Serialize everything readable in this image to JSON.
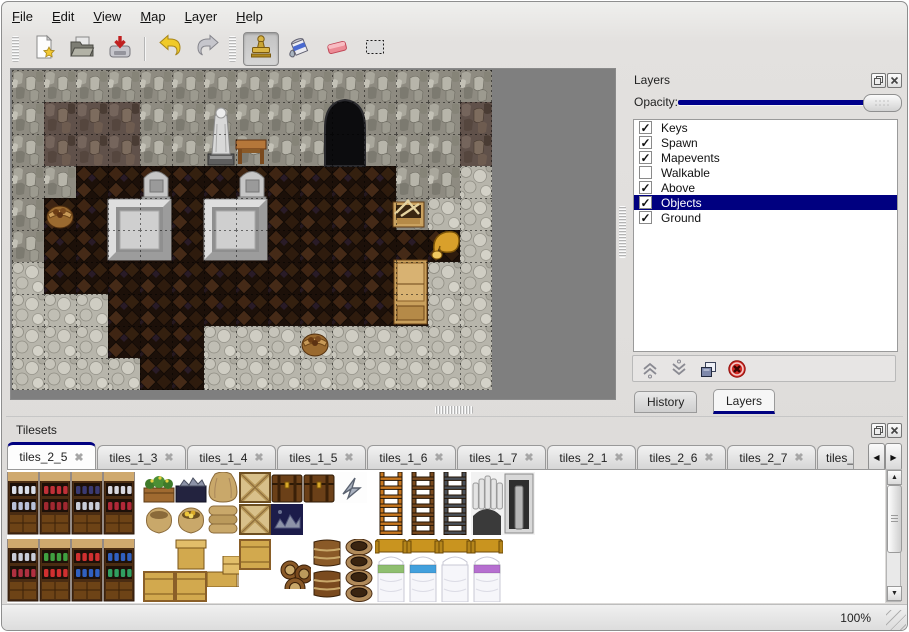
{
  "menu": {
    "items": [
      "File",
      "Edit",
      "View",
      "Map",
      "Layer",
      "Help"
    ]
  },
  "toolbar": {
    "buttons": [
      {
        "name": "new-file",
        "icon": "new"
      },
      {
        "name": "open-file",
        "icon": "open"
      },
      {
        "name": "save-file",
        "icon": "save"
      },
      {
        "name": "undo",
        "icon": "undo"
      },
      {
        "name": "redo",
        "icon": "redo"
      },
      {
        "name": "stamp-tool",
        "icon": "stamp",
        "active": true
      },
      {
        "name": "fill-tool",
        "icon": "fill"
      },
      {
        "name": "eraser-tool",
        "icon": "eraser"
      },
      {
        "name": "select-tool",
        "icon": "select"
      }
    ]
  },
  "layers_panel": {
    "title": "Layers",
    "opacity_label": "Opacity:",
    "opacity_value": 1.0,
    "layers": [
      {
        "label": "Keys",
        "checked": true,
        "selected": false
      },
      {
        "label": "Spawn",
        "checked": true,
        "selected": false
      },
      {
        "label": "Mapevents",
        "checked": true,
        "selected": false
      },
      {
        "label": "Walkable",
        "checked": false,
        "selected": false
      },
      {
        "label": "Above",
        "checked": true,
        "selected": false
      },
      {
        "label": "Objects",
        "checked": true,
        "selected": true
      },
      {
        "label": "Ground",
        "checked": true,
        "selected": false
      }
    ],
    "buttons": [
      "move-layer-up",
      "move-layer-down",
      "duplicate-layer",
      "delete-layer"
    ],
    "tabs": [
      {
        "label": "History",
        "active": false
      },
      {
        "label": "Layers",
        "active": true
      }
    ]
  },
  "tilesets_panel": {
    "title": "Tilesets",
    "tabs": [
      "tiles_2_5",
      "tiles_1_3",
      "tiles_1_4",
      "tiles_1_5",
      "tiles_1_6",
      "tiles_1_7",
      "tiles_2_1",
      "tiles_2_6",
      "tiles_2_7",
      "tiles_"
    ],
    "active_tab": "tiles_2_5"
  },
  "statusbar": {
    "zoom": "100%"
  },
  "colors": {
    "accent_navy": "#000080",
    "slider_navy": "#00008b",
    "map_bg": "#7f7f7f",
    "wall": "#8e8b81",
    "wall_dark": "#60514a",
    "rubble": "#b7b5ab",
    "floor": "#2b1a0e",
    "wood": "#c9a05c",
    "gold": "#d9a02b",
    "stone_light": "#d9d9d9"
  },
  "map": {
    "tile_size": 32,
    "grid_rows": [
      "WWWWWWWWWWWWWWW",
      "WDDDWWWWWWWWWWD",
      "WDDDWWWWWWWWWWD",
      "WWFFFFFFFFFFWWR",
      "WFFFFFFFFFFFWRR",
      "WFFFFFFFFFFFFFR",
      "RFFFFFFFFFFFFRR",
      "RRRFFFFFFFFFFRR",
      "RRRFFFRRRRRRRRR",
      "RRRRFFRRRRRRRRR"
    ],
    "objects": [
      {
        "t": "cave",
        "x": 313,
        "y": 28
      },
      {
        "t": "statue",
        "x": 194,
        "y": 34
      },
      {
        "t": "table",
        "x": 224,
        "y": 66
      },
      {
        "t": "tomb",
        "x": 129,
        "y": 97
      },
      {
        "t": "tomb",
        "x": 225,
        "y": 97
      },
      {
        "t": "block",
        "x": 96,
        "y": 129
      },
      {
        "t": "block",
        "x": 192,
        "y": 129
      },
      {
        "t": "basket",
        "x": 34,
        "y": 131
      },
      {
        "t": "crate",
        "x": 381,
        "y": 126
      },
      {
        "t": "horn",
        "x": 417,
        "y": 158
      },
      {
        "t": "cabinet",
        "x": 382,
        "y": 190
      },
      {
        "t": "basket",
        "x": 289,
        "y": 259
      }
    ]
  },
  "tileset_tiles": [
    {
      "k": "shelf",
      "x": 0,
      "y": 2,
      "a": "#d8dde8",
      "b": "#b8c0d8"
    },
    {
      "k": "shelf",
      "x": 32,
      "y": 2,
      "a": "#c03038",
      "b": "#a02830"
    },
    {
      "k": "shelf",
      "x": 64,
      "y": 2,
      "a": "#3a3a72",
      "b": "#c8ccd8"
    },
    {
      "k": "shelf",
      "x": 96,
      "y": 2,
      "a": "#d8d8e0",
      "b": "#b02838"
    },
    {
      "k": "flowerbox",
      "x": 136,
      "y": 2
    },
    {
      "k": "sackopen",
      "x": 136,
      "y": 34
    },
    {
      "k": "orebox",
      "x": 168,
      "y": 2
    },
    {
      "k": "sackgold",
      "x": 168,
      "y": 34
    },
    {
      "k": "sacktall",
      "x": 200,
      "y": 2
    },
    {
      "k": "sackpile",
      "x": 200,
      "y": 34
    },
    {
      "k": "cratex",
      "x": 232,
      "y": 2
    },
    {
      "k": "cratex",
      "x": 232,
      "y": 34
    },
    {
      "k": "chest",
      "x": 264,
      "y": 2
    },
    {
      "k": "oreblue",
      "x": 264,
      "y": 34
    },
    {
      "k": "chest",
      "x": 296,
      "y": 2
    },
    {
      "k": "rune",
      "x": 328,
      "y": 2
    },
    {
      "k": "ladder",
      "x": 368,
      "y": 2,
      "c": "#c87820"
    },
    {
      "k": "ladder",
      "x": 400,
      "y": 2,
      "c": "#7a4a1e"
    },
    {
      "k": "ladder",
      "x": 432,
      "y": 2,
      "c": "#4a5058"
    },
    {
      "k": "arch",
      "x": 464,
      "y": 2
    },
    {
      "k": "archdoor",
      "x": 496,
      "y": 2
    },
    {
      "k": "shelf2",
      "x": 0,
      "y": 69,
      "a": "#c8ccd8",
      "b": "#b03040"
    },
    {
      "k": "shelf2",
      "x": 32,
      "y": 69,
      "a": "#40a040",
      "b": "#d03030"
    },
    {
      "k": "shelf2",
      "x": 64,
      "y": 69,
      "a": "#d03030",
      "b": "#3060c0"
    },
    {
      "k": "shelf2",
      "x": 96,
      "y": 69,
      "a": "#3060c0",
      "b": "#30a060"
    },
    {
      "k": "crate",
      "x": 136,
      "y": 101
    },
    {
      "k": "cratelid",
      "x": 168,
      "y": 69
    },
    {
      "k": "crate",
      "x": 168,
      "y": 101
    },
    {
      "k": "crate",
      "x": 232,
      "y": 69
    },
    {
      "k": "cratepile",
      "x": 200,
      "y": 86
    },
    {
      "k": "barrelpile",
      "x": 272,
      "y": 88
    },
    {
      "k": "barrelstack",
      "x": 304,
      "y": 69
    },
    {
      "k": "potstack",
      "x": 336,
      "y": 69
    },
    {
      "k": "bed",
      "x": 368,
      "y": 69,
      "c": "#8fbf6f"
    },
    {
      "k": "bed",
      "x": 400,
      "y": 69,
      "c": "#42a0dd"
    },
    {
      "k": "bed",
      "x": 432,
      "y": 69,
      "c": ""
    },
    {
      "k": "bed",
      "x": 464,
      "y": 69,
      "c": "#b66fd0"
    }
  ]
}
